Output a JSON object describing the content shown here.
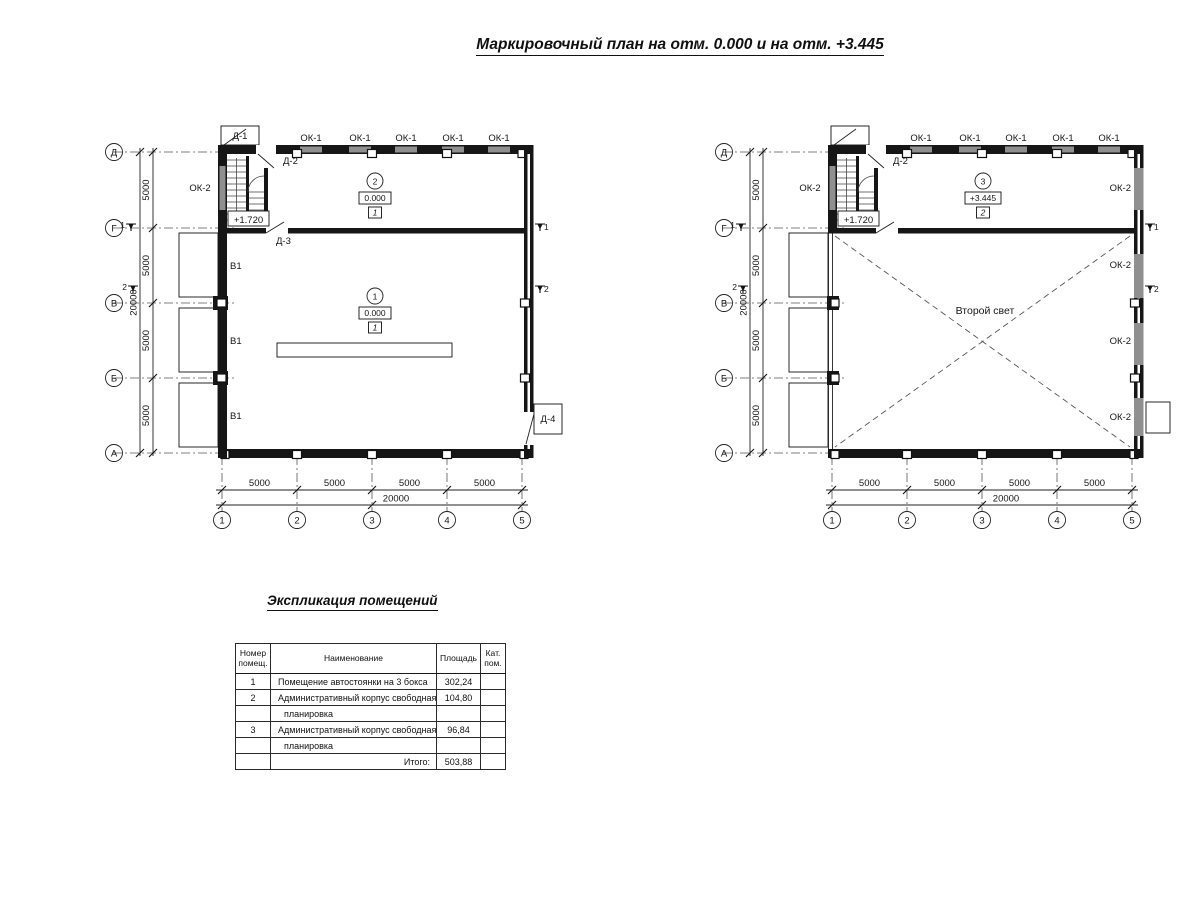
{
  "title": "Маркировочный план на отм. 0.000 и на отм. +3.445",
  "axes": {
    "rows": [
      "Д",
      "Г",
      "В",
      "Б",
      "А"
    ],
    "cols": [
      "1",
      "2",
      "3",
      "4",
      "5"
    ]
  },
  "dims": {
    "bay": "5000",
    "total": "20000"
  },
  "labels": {
    "ok1": "ОК-1",
    "ok2": "ОК-2",
    "v1": "В1",
    "d1": "Д-1",
    "d2": "Д-2",
    "d3": "Д-3",
    "d4": "Д-4",
    "stair_level": "+1.720",
    "second_light": "Второй свет",
    "sec1": "1",
    "sec2": "2"
  },
  "markers": {
    "room1": {
      "num": "1",
      "elev": "0.000",
      "floor": "1"
    },
    "room2": {
      "num": "2",
      "elev": "0.000",
      "floor": "1"
    },
    "room3": {
      "num": "3",
      "elev": "+3.445",
      "floor": "2"
    }
  },
  "schedule": {
    "title": "Экспликация помещений",
    "headers": {
      "num": "Номер помещ.",
      "name": "Наименование",
      "area": "Площадь",
      "cat": "Кат. пом."
    },
    "rows": [
      {
        "num": "1",
        "name": "Помещение автостоянки на 3 бокса",
        "area": "302,24",
        "cat": ""
      },
      {
        "num": "2",
        "name": "Административный корпус свободная",
        "area": "104,80",
        "cat": ""
      },
      {
        "num": "",
        "name": "планировка",
        "area": "",
        "cat": ""
      },
      {
        "num": "3",
        "name": "Административный корпус свободная",
        "area": "96,84",
        "cat": ""
      },
      {
        "num": "",
        "name": "планировка",
        "area": "",
        "cat": ""
      }
    ],
    "total_label": "Итого:",
    "total_value": "503,88"
  }
}
